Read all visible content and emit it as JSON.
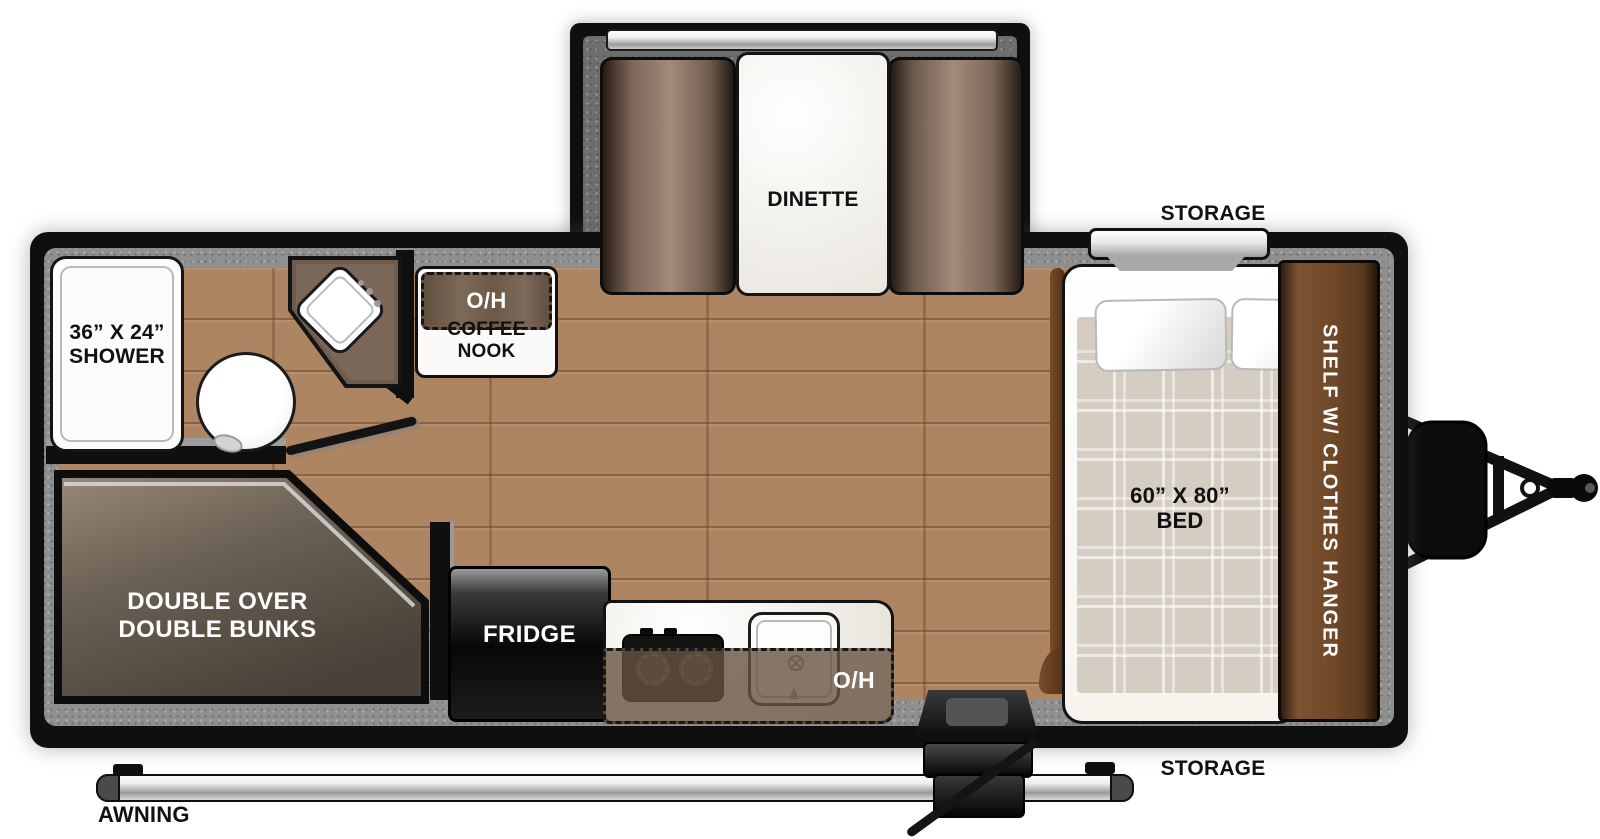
{
  "colors": {
    "wall_black": "#0f0f0f",
    "wall_trim_gray": "#8f8f8f",
    "floor_wood": "#ae8563",
    "cabinet_brown": "#6f4828",
    "bench_brown": "#a38a79",
    "bunk_brown": "#6b6054",
    "counter_marble": "#f1eee8",
    "overhead_tint": "#685442",
    "blanket_beige": "#d5ccc2",
    "awning_silver": "#c9c9c9"
  },
  "slideout": {
    "label": "DINETTE"
  },
  "bathroom": {
    "shower_size": "36” X 24”",
    "shower_name": "SHOWER"
  },
  "bunk_room": {
    "line1": "DOUBLE OVER",
    "line2": "DOUBLE BUNKS"
  },
  "kitchen": {
    "fridge_label": "FRIDGE",
    "overhead_label": "O/H"
  },
  "coffee_nook": {
    "overhead_label": "O/H",
    "label": "COFFEE NOOK"
  },
  "bedroom": {
    "bed_size": "60” X 80”",
    "bed_name": "BED",
    "wardrobe_label": "SHELF W/ CLOTHES HANGER"
  },
  "exterior": {
    "storage_top_label": "STORAGE",
    "storage_bottom_label": "STORAGE",
    "awning_label": "AWNING"
  }
}
